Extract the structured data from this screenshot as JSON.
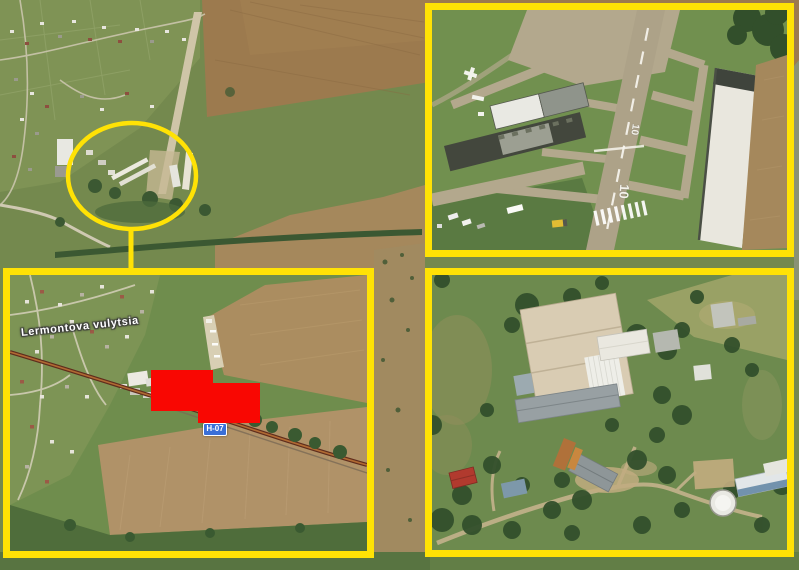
{
  "colors": {
    "annotation_yellow": "#FFE205",
    "redaction_red": "#F90702",
    "road_badge_blue": "#3A6FD8",
    "runway_marking_white": "#F4F2EA",
    "street_label_white": "#FFFFFF"
  },
  "inset": {
    "street_label": "Lermontova vulytsia",
    "road_badge": "H-07"
  },
  "airfield": {
    "runway_number_far": "10",
    "runway_number_near": "10"
  }
}
